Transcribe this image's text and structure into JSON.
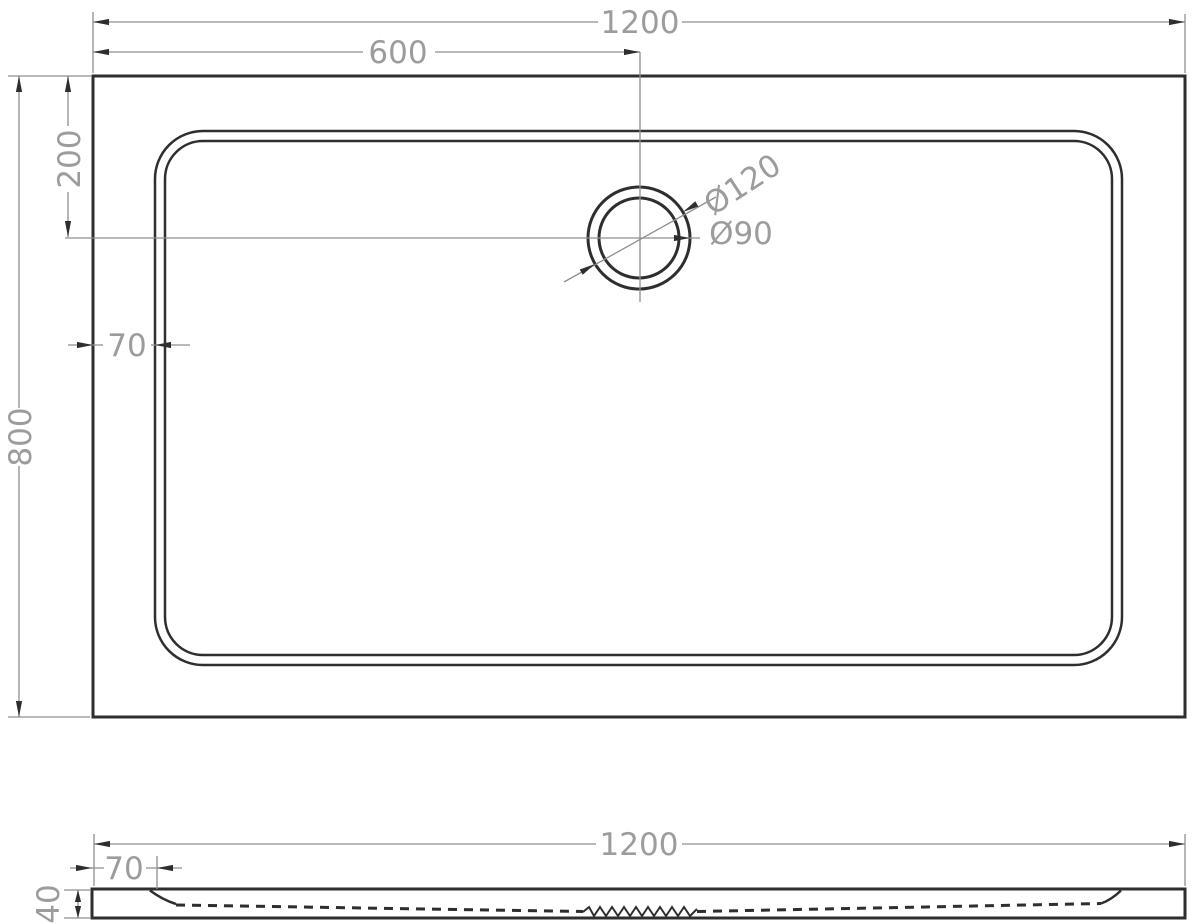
{
  "drawing": {
    "description": "Technical dimension drawing of rectangular shower tray, top view and side section view",
    "colors": {
      "object_line": "#2e2e2e",
      "dim_line": "#8f8f8f",
      "dim_text": "#9c9c9c",
      "background": "#ffffff"
    }
  },
  "top_view": {
    "dim_width": "1200",
    "dim_drain_offset_x": "600",
    "dim_drain_offset_y": "200",
    "dim_rim": "70",
    "dim_depth": "800",
    "dim_drain_outer": "Ø120",
    "dim_drain_inner": "Ø90"
  },
  "side_view": {
    "dim_width": "1200",
    "dim_rim": "70",
    "dim_height": "40"
  }
}
